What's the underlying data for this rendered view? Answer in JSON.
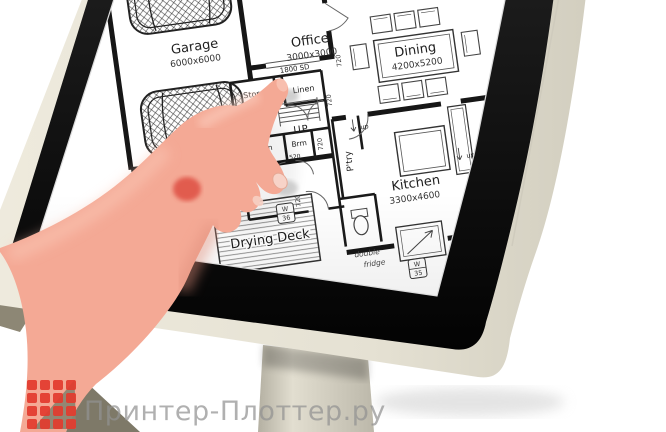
{
  "brand": {
    "text": "Принтер-Плоттер.ру",
    "logo_color": "#e23b2e",
    "logo_fold_color": "#8a8470",
    "text_color": "#919191"
  },
  "device": {
    "screen_background": "#ffffff",
    "bezel_outer_color": "#e7e3d6",
    "bezel_inner_color": "#0f0f0f",
    "stand_color": "#d9d5c7"
  },
  "hand": {
    "skin_color": "#f4a995",
    "nail_color": "#f7d3c8"
  },
  "floor_plan": {
    "rooms": [
      {
        "name": "Garage",
        "dims": "6000x6000"
      },
      {
        "name": "Office",
        "dims": "3000x3000"
      },
      {
        "name": "Dining",
        "dims": "4200x5200"
      },
      {
        "name": "Kitchen",
        "dims": "3300x4600"
      },
      {
        "name": "Drying Deck",
        "dims": ""
      },
      {
        "name": "Store",
        "dims": ""
      },
      {
        "name": "Linen",
        "dims": ""
      },
      {
        "name": "Store",
        "dims": ""
      },
      {
        "name": "Linen",
        "dims": ""
      },
      {
        "name": "Brm",
        "dims": ""
      },
      {
        "name": "P'try",
        "dims": ""
      }
    ],
    "stairs_label": "UP",
    "door_labels": {
      "sliding_door": "1800 SD",
      "door_720": "720",
      "door_520": "520",
      "door_2x820": "2x820",
      "step_up": "up"
    },
    "window_tags": [
      {
        "letter": "W",
        "number": "36"
      },
      {
        "letter": "W",
        "number": "35"
      }
    ],
    "annotations": {
      "fridge_line1": "double",
      "fridge_line2": "fridge"
    }
  }
}
